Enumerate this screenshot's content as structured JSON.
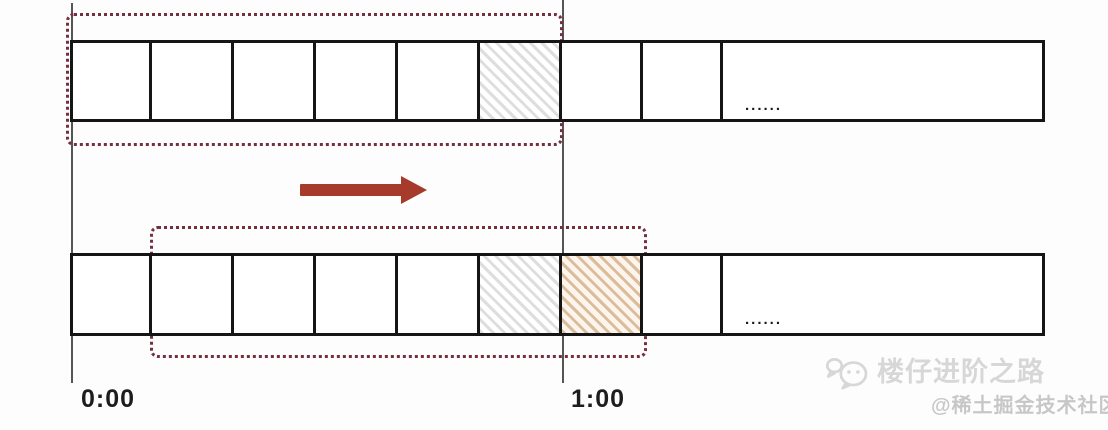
{
  "labels": {
    "time_start": "0:00",
    "time_end": "1:00",
    "ellipsis": "......"
  },
  "rows": [
    {
      "name": "timeline-before-slide",
      "cells": [
        "plain",
        "plain",
        "plain",
        "plain",
        "plain",
        "hatch_gray",
        "plain",
        "plain",
        "ellipsis"
      ]
    },
    {
      "name": "timeline-after-slide",
      "cells": [
        "plain",
        "plain",
        "plain",
        "plain",
        "plain",
        "hatch_gray",
        "hatch_brown",
        "plain",
        "ellipsis"
      ]
    }
  ],
  "colors": {
    "window_border": "#753040",
    "arrow": "#a63b2b",
    "bar_border": "#151515",
    "axis_line": "#555555",
    "hatch_gray": "#dedede",
    "hatch_brown": "#d9bd9c",
    "label": "#1d1d1d",
    "watermark_primary": "#d7d7d7",
    "watermark_secondary": "#c7c7c7"
  },
  "watermarks": {
    "primary": {
      "icon": "wechat-icon",
      "text": "楼仔进阶之路"
    },
    "secondary": {
      "text": "@稀土掘金技术社区"
    }
  }
}
